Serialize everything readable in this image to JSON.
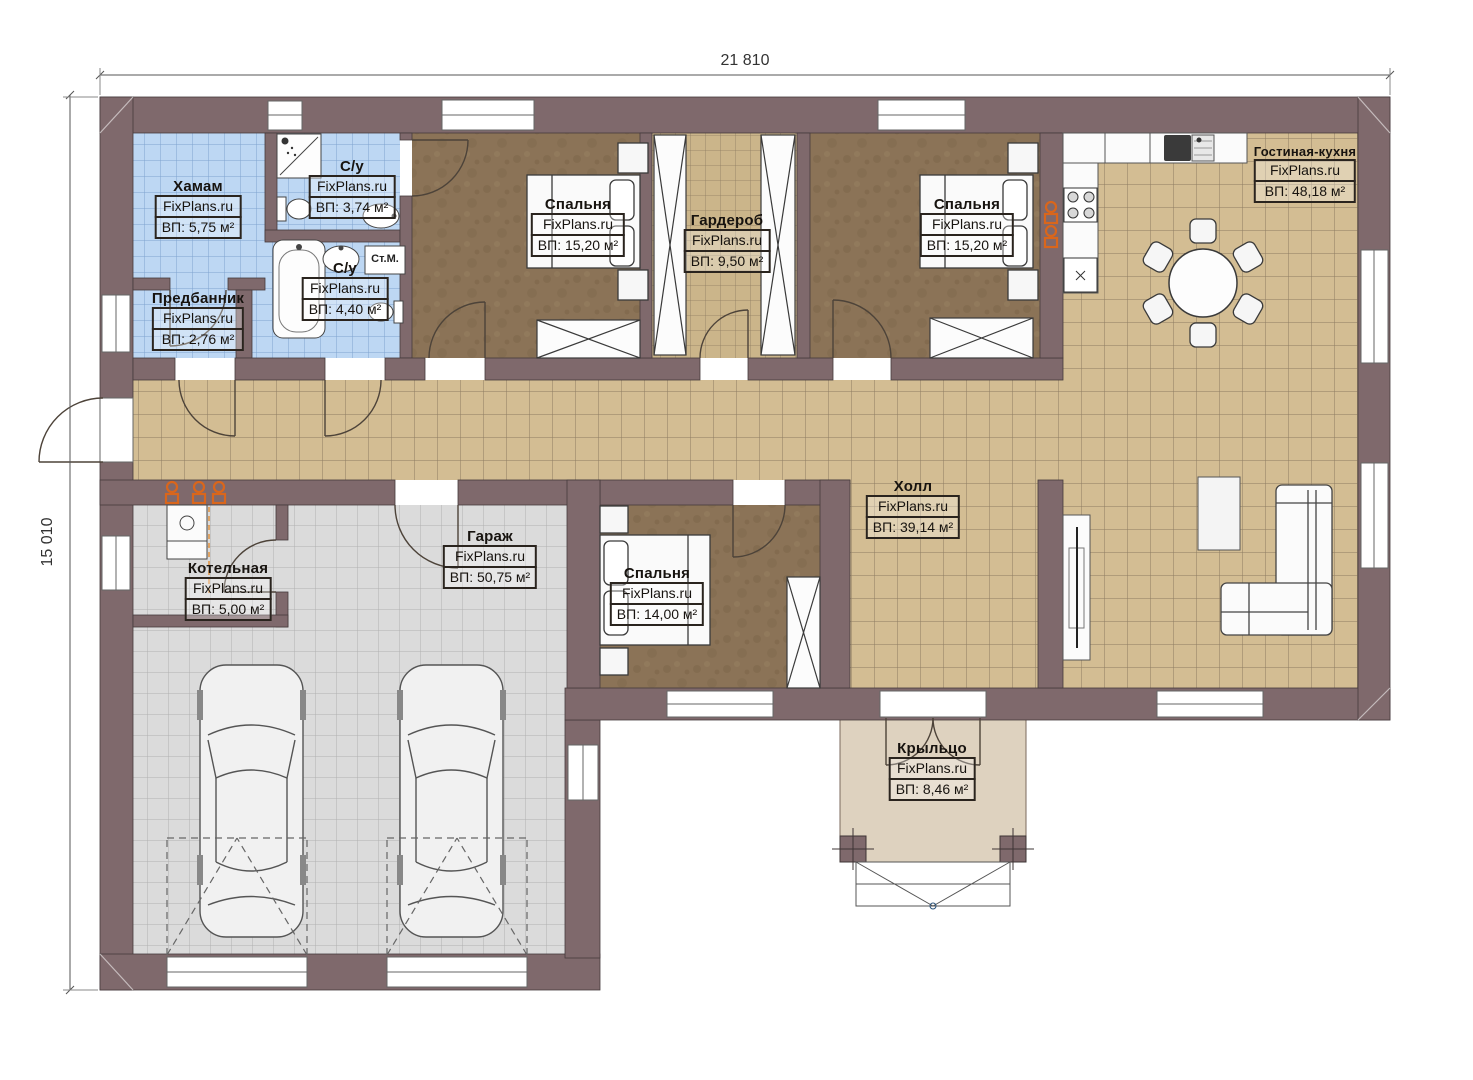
{
  "dimensions": {
    "width_label": "21 810",
    "height_label": "15 010"
  },
  "watermark": "FixPlans.ru",
  "rooms": {
    "hamam": {
      "name": "Хамам",
      "area": "ВП: 5,75 м²"
    },
    "su_top": {
      "name": "С/у",
      "area": "ВП: 3,74 м²"
    },
    "su_bottom": {
      "name": "С/у",
      "area": "ВП: 4,40 м²"
    },
    "predbannik": {
      "name": "Предбанник",
      "area": "ВП: 2,76 м²"
    },
    "bedroom_left": {
      "name": "Спальня",
      "area": "ВП: 15,20 м²"
    },
    "garderob": {
      "name": "Гардероб",
      "area": "ВП: 9,50 м²"
    },
    "bedroom_right": {
      "name": "Спальня",
      "area": "ВП: 15,20 м²"
    },
    "living_kitchen": {
      "name": "Гостиная-кухня",
      "area": "ВП: 48,18 м²"
    },
    "kotelnaya": {
      "name": "Котельная",
      "area": "ВП: 5,00 м²"
    },
    "garage": {
      "name": "Гараж",
      "area": "ВП: 50,75 м²"
    },
    "bedroom_bottom": {
      "name": "Спальня",
      "area": "ВП: 14,00 м²"
    },
    "hall": {
      "name": "Холл",
      "area": "ВП: 39,14 м²"
    },
    "porch": {
      "name": "Крыльцо",
      "area": "ВП: 8,46 м²"
    }
  },
  "labels": {
    "washing_machine": "Ст.М."
  },
  "palette": {
    "wall": "#7f696c",
    "tile_blue": "#bdd7f3",
    "tile_beige": "#d3bd93",
    "tile_gray": "#dbdbdb",
    "floor_brown": "#8b7357",
    "porch_floor": "#ded2bf",
    "accent_orange": "#d9661c"
  }
}
